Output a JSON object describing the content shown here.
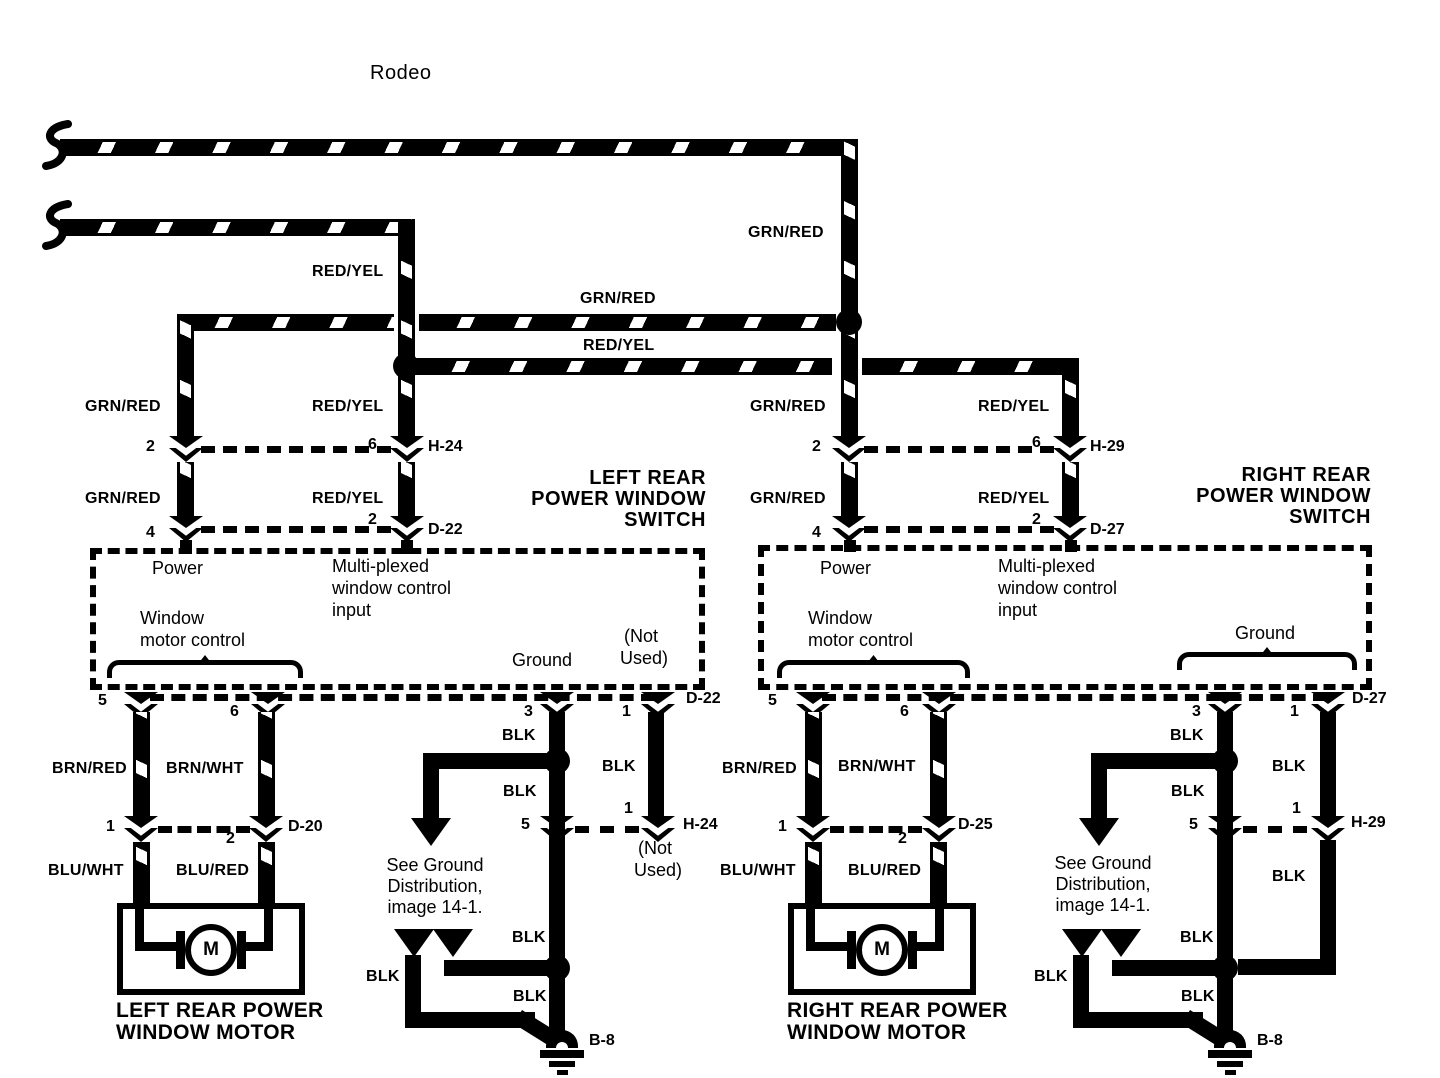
{
  "title": "Rodeo",
  "colors": {
    "grn_red": "GRN/RED",
    "red_yel": "RED/YEL",
    "brn_red": "BRN/RED",
    "brn_wht": "BRN/WHT",
    "blu_wht": "BLU/WHT",
    "blu_red": "BLU/RED",
    "blk": "BLK"
  },
  "pins": {
    "p1": "1",
    "p2": "2",
    "p3": "3",
    "p4": "4",
    "p5": "5",
    "p6": "6"
  },
  "connectors": {
    "h24": "H-24",
    "d22": "D-22",
    "d20": "D-20",
    "h29": "H-29",
    "d27": "D-27",
    "d25": "D-25",
    "b8": "B-8"
  },
  "left_switch": {
    "title_lines": [
      "LEFT REAR",
      "POWER WINDOW",
      "SWITCH"
    ],
    "power": "Power",
    "multiplexed_lines": [
      "Multi-plexed",
      "window control",
      "input"
    ],
    "window_motor_lines": [
      "Window",
      "motor control"
    ],
    "ground": "Ground",
    "not_used_lines": [
      "(Not",
      "Used)"
    ]
  },
  "right_switch": {
    "title_lines": [
      "RIGHT REAR",
      "POWER WINDOW",
      "SWITCH"
    ],
    "power": "Power",
    "multiplexed_lines": [
      "Multi-plexed",
      "window control",
      "input"
    ],
    "window_motor_lines": [
      "Window",
      "motor control"
    ],
    "ground": "Ground"
  },
  "left_motor": {
    "label": "M",
    "title_lines": [
      "LEFT REAR POWER",
      "WINDOW MOTOR"
    ]
  },
  "right_motor": {
    "label": "M",
    "title_lines": [
      "RIGHT REAR POWER",
      "WINDOW MOTOR"
    ]
  },
  "ground_note_lines": [
    "See Ground",
    "Distribution,",
    "image 14-1."
  ]
}
